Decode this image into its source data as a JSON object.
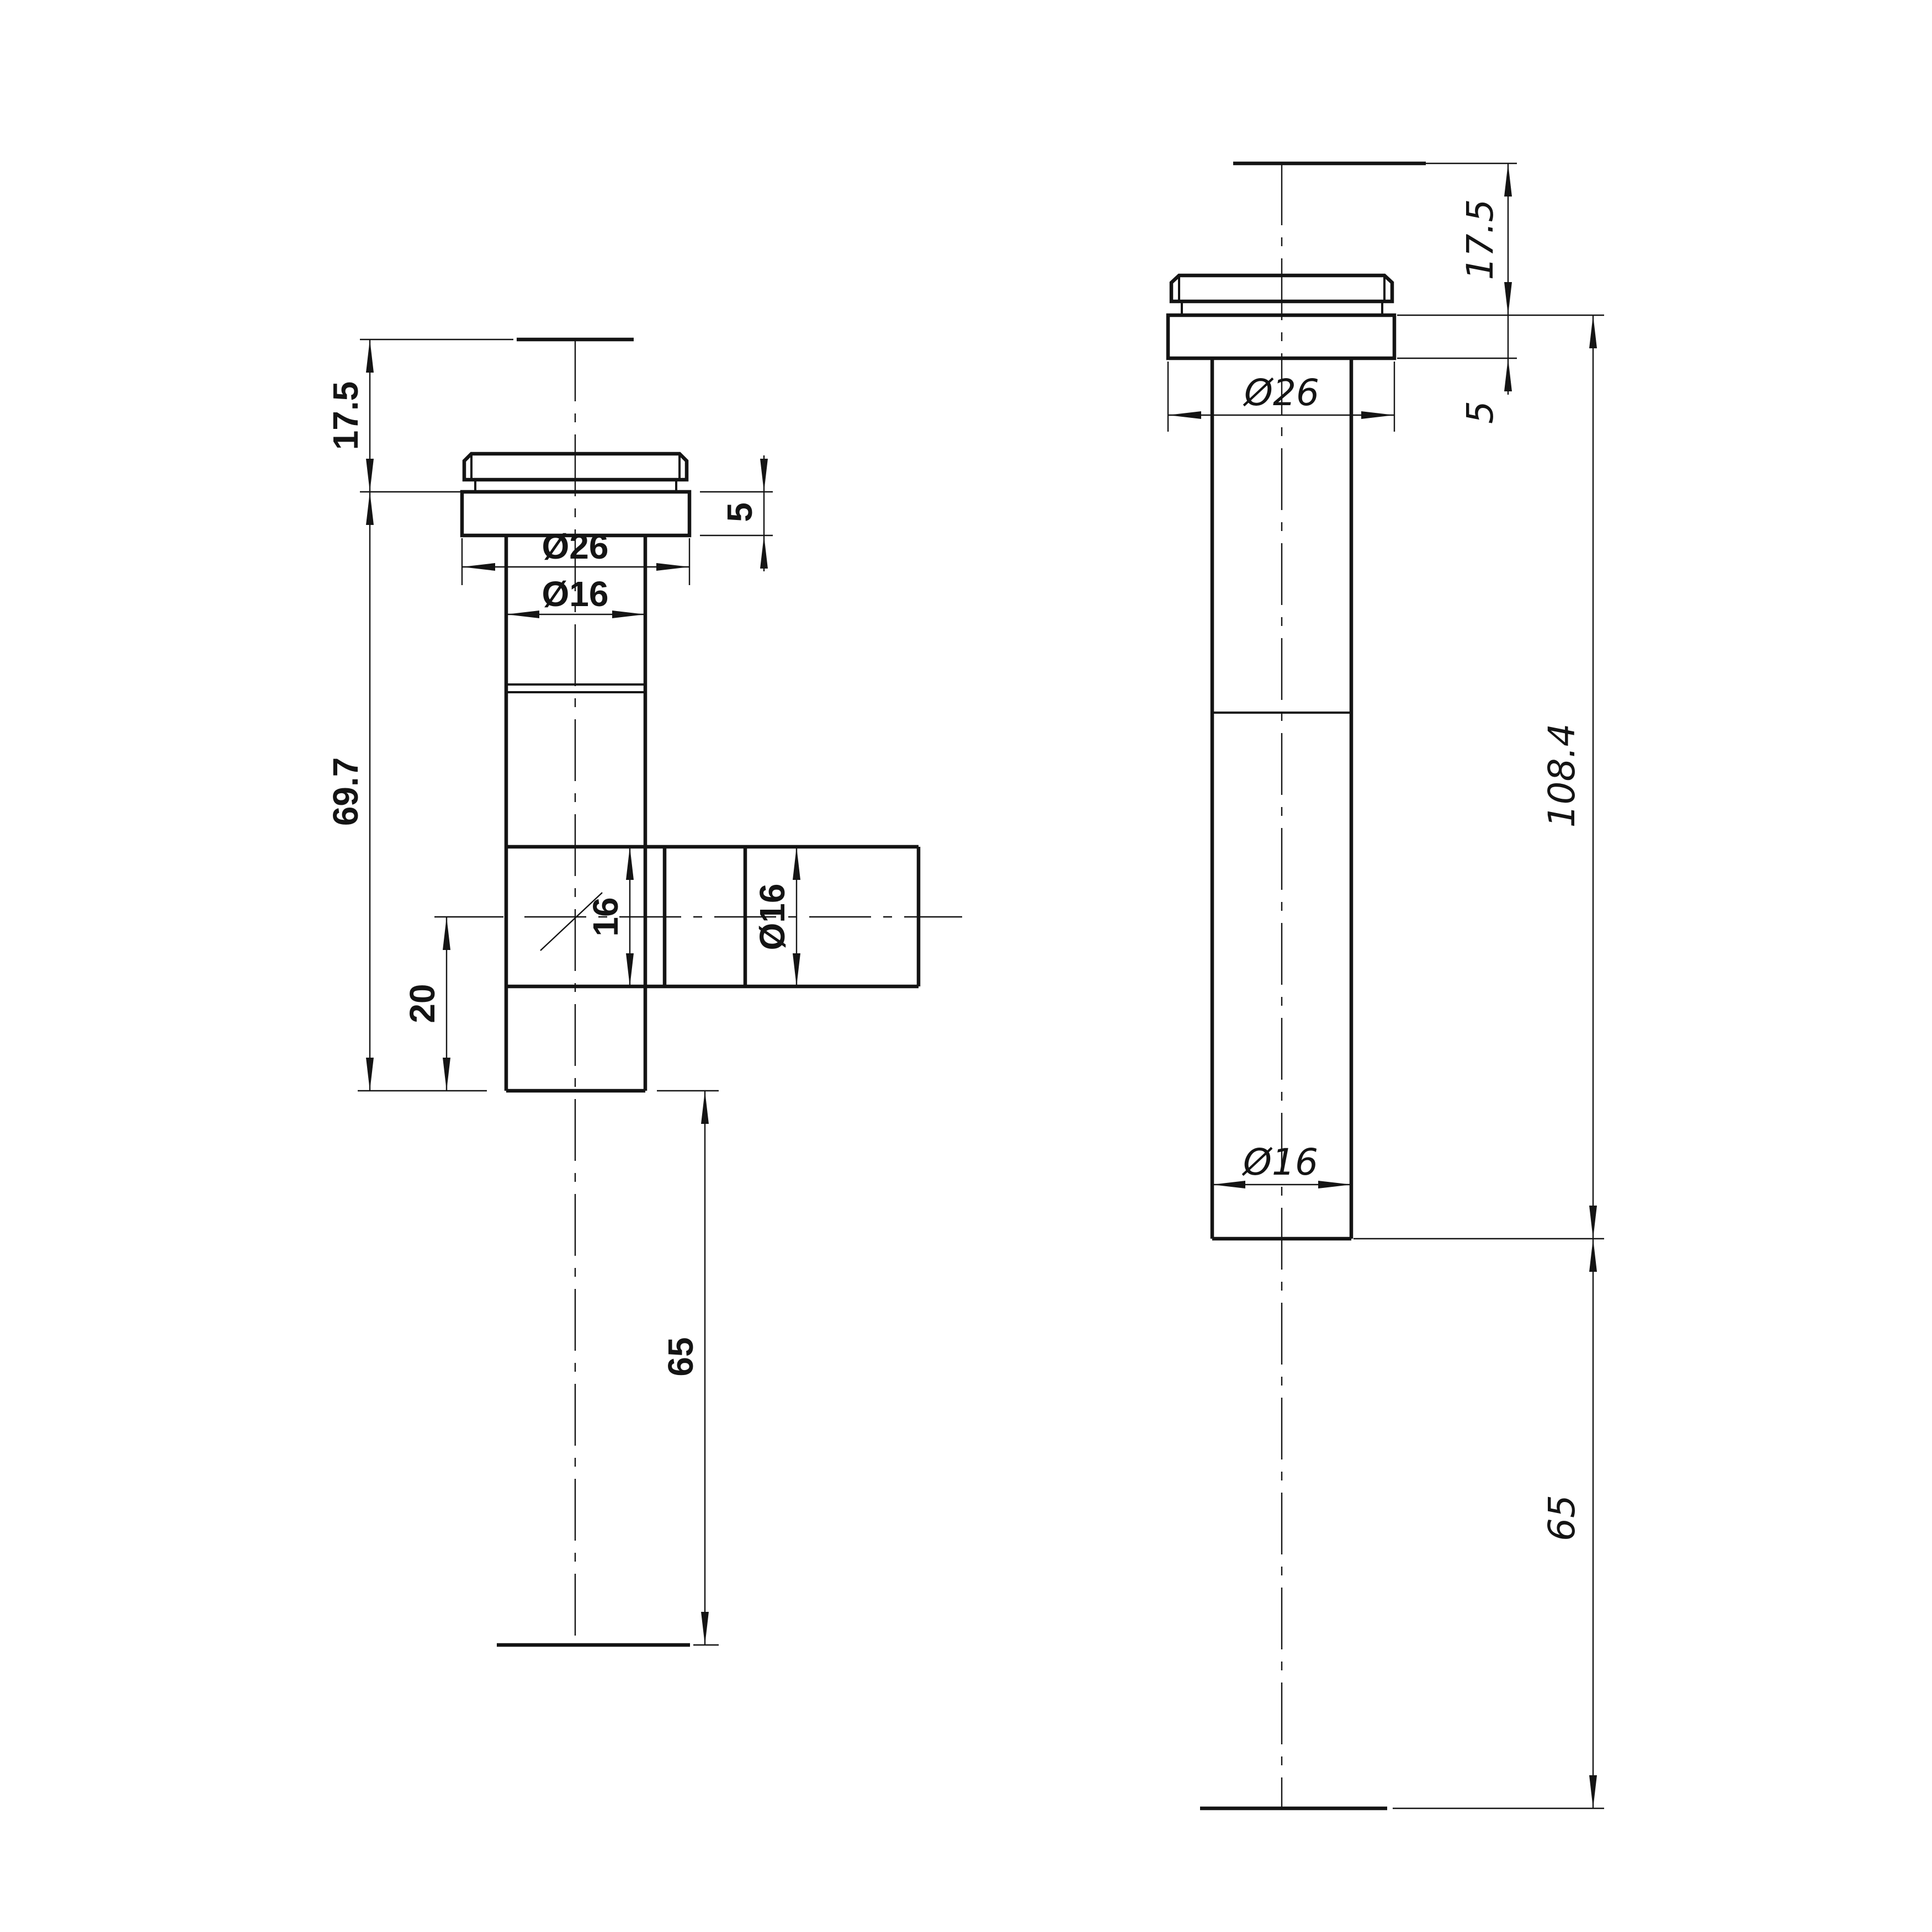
{
  "page": {
    "background": "#ffffff",
    "line_color": "#141414",
    "description": "CAD dimension drawing of a tee pipe fitting (front view) and straight fitting (side view)"
  },
  "views": {
    "left": {
      "name": "tee-fitting-view",
      "labels": {
        "height_17_5": "17.5",
        "flange_height_5": "5",
        "flange_dia": "Ø26",
        "pipe_dia": "Ø16",
        "body_height": "69.7",
        "branch_height": "16",
        "branch_dia": "Ø16",
        "offset_20": "20",
        "depth_65": "65"
      }
    },
    "right": {
      "name": "straight-fitting-view",
      "labels": {
        "height_17_5": "17.5",
        "flange_height_5": "5",
        "flange_dia": "Ø26",
        "overall_height": "108.4",
        "pipe_dia": "Ø16",
        "depth_65": "65"
      }
    }
  }
}
